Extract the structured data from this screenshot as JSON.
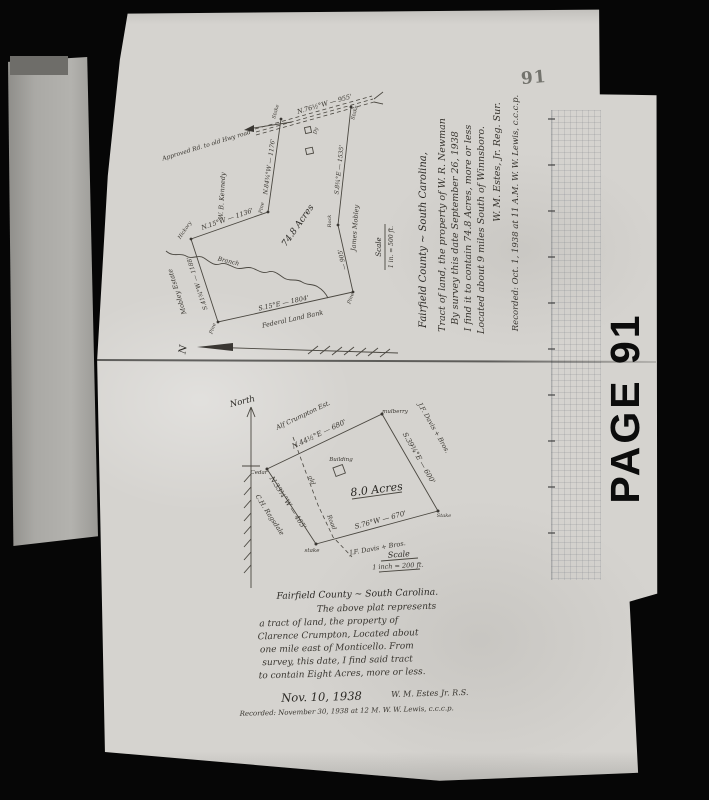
{
  "page": {
    "number": "91",
    "stamp": "PAGE 91"
  },
  "colors": {
    "film_black": "#060606",
    "paper": "#d5d3cf",
    "ink": "#38352f",
    "stamp_ink": "#0c0c0c"
  },
  "icons": {
    "top_north_arrow": "north-arrow",
    "bottom_north_arrow": "north-arrow"
  },
  "top_plat": {
    "road_label": "Approved Rd. to old Hwy road",
    "road_bearing": "N.76½°W — 955'",
    "stake_west": "Stake",
    "stake_east": "Stake",
    "bearing_west_line": "N.84¾°W — 1176'",
    "bearing_north_line": "N.15°W — 1136'",
    "bearing_left_line": "S.41¾°W — 1188'",
    "bearing_bottom_line": "S.15°E — 1804'",
    "bearing_right_upper": "S.8¾°E — 1535'",
    "bearing_right_lower": "— 905'",
    "corner_hickory": "Hickory",
    "corner_pine_west": "Pine",
    "corner_pine_south": "Pine",
    "corner_pine_east": "Pine",
    "corner_rock": "Rock",
    "owner_kennedy": "W. B. Kennedy",
    "owner_mobley_estate": "Mobley Estate",
    "owner_james_mobley": "James Mobley",
    "owner_federal": "Federal Land Bank",
    "creek_label": "Branch",
    "acreage": "74.8 Acres",
    "building_mark": "Dy",
    "scale_title": "Scale",
    "scale_value": "1 in. = 500 ft.",
    "north_letter": "N",
    "caption": [
      "Fairfield County ~ South Carolina,",
      "Tract of land, the property of W. R. Newman",
      "By survey this date September 26, 1938",
      "I find it to contain 74.8 Acres, more or less",
      "Located about 9 miles South of Winnsboro.",
      "W. M. Estes, Jr.    Reg. Sur.",
      "Recorded: Oct. 1, 1938 at 11 A.M.    W. W. Lewis, c.c.c.p."
    ]
  },
  "bottom_plat": {
    "north_label": "North",
    "side_ne": "N.44½°E — 680'",
    "side_se": "S.39¾°E — 600'",
    "side_sw": "S.76°W — 670'",
    "side_nw": "N.33¾°W — 465'",
    "corner_cedar": "Cedar",
    "corner_mulberry": "mulberry",
    "corner_stake_e": "Stake",
    "corner_stake_s": "stake",
    "owner_nw": "Alf Crumpton Est.",
    "owner_ne": "J.F. Davis + Bros.",
    "owner_s": "J.F. Davis + Bros.",
    "owner_w": "C.H. Ragsdale",
    "road_word_1": "old",
    "road_word_2": "Road",
    "building_label": "Building",
    "acreage": "8.0 Acres",
    "scale_title": "Scale",
    "scale_value": "1 inch = 200 ft.",
    "caption": [
      "Fairfield County ~ South Carolina.",
      "The above plat represents",
      "a tract of land, the property of",
      "Clarence Crumpton,  Located about",
      "one mile east of Monticello.  From",
      "survey, this date, I find said tract",
      "to contain Eight Acres, more or less."
    ],
    "date": "Nov. 10, 1938",
    "surveyor": "W. M. Estes Jr.  R.S.",
    "recorded": "Recorded: November 30, 1938 at 12 M.   W. W. Lewis, c.c.c.p."
  }
}
